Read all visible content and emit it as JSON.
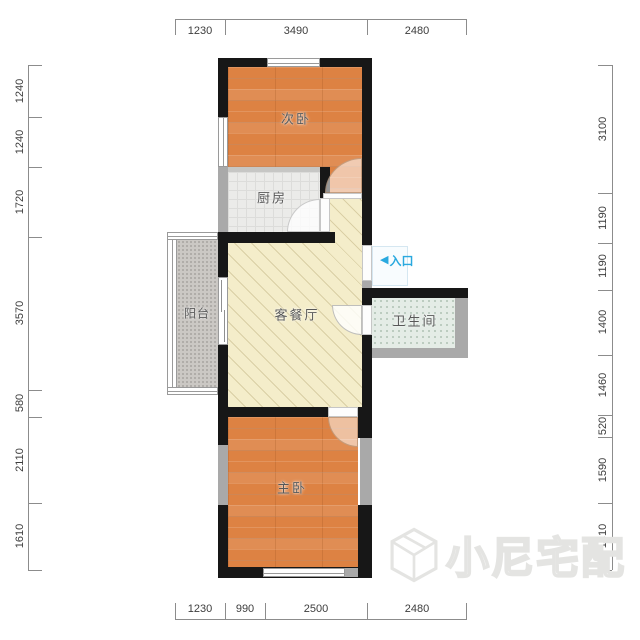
{
  "plan": {
    "rooms": {
      "bedroom2": "次卧",
      "kitchen": "厨房",
      "living": "客餐厅",
      "balcony": "阳台",
      "bathroom": "卫生间",
      "bedroom1": "主卧"
    },
    "entrance": {
      "arrow": "◀",
      "label": "入口"
    }
  },
  "dims": {
    "top": {
      "d0": "1230",
      "d1": "3490",
      "d2": "2480"
    },
    "bottom": {
      "d0": "1230",
      "d1": "990",
      "d2": "2500",
      "d3": "2480"
    },
    "left": {
      "d0": "1240",
      "d1": "1240",
      "d2": "1720",
      "d3": "3570",
      "d4": "580",
      "d5": "2110",
      "d6": "1610"
    },
    "right": {
      "d0": "3100",
      "d1": "1190",
      "d2": "1190",
      "d3": "1400",
      "d4": "1460",
      "d5": "520",
      "d6": "1590",
      "d7": "1610"
    }
  },
  "watermark": {
    "brand": "小尼宅配"
  },
  "colors": {
    "wall": "#171717",
    "wall_light": "#a9a9a9",
    "bedroom_floor": "#dd8243",
    "living_floor": "#f4edca",
    "kitchen_floor": "#ebebe9",
    "bathroom_floor": "#e4ece6",
    "balcony_floor": "#cbc8c4",
    "entrance_accent": "#2aa9df",
    "dimension_text": "#3d3d3d",
    "watermark": "#e4e4e2"
  }
}
